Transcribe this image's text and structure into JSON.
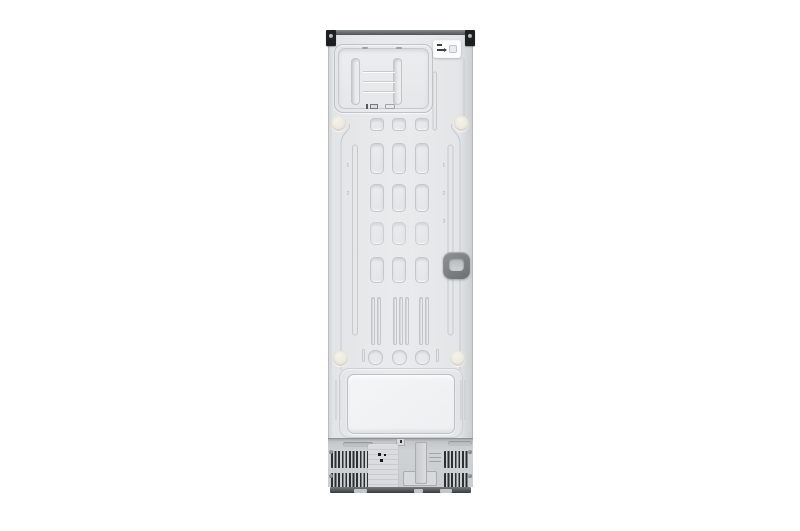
{
  "subject": {
    "type": "appliance-product-photo",
    "name": "refrigerator back panel"
  },
  "etched_markers": {
    "left": [
      "1",
      "2"
    ],
    "right": [
      "1",
      "2",
      "3"
    ]
  },
  "colors": {
    "background": "#ffffff",
    "panel": "#e7e9eb",
    "panel_emboss_line": "#c6cacc",
    "top_cap": "#4e5254",
    "corner_bracket": "#1d1f21",
    "vent_slat": "#2d3032",
    "base_rail": "#393c3e",
    "recessed_handle": "#767a7d",
    "screw_boss": "#ece8de",
    "sticker": "#fbfcfc",
    "tray_recess": "#f1f3f4",
    "compressor_bay": "#cfd2d4"
  },
  "icons": {
    "sticker_icon": "plug-removal-diagram",
    "plate_icon": "three-dot-warning-cluster"
  }
}
